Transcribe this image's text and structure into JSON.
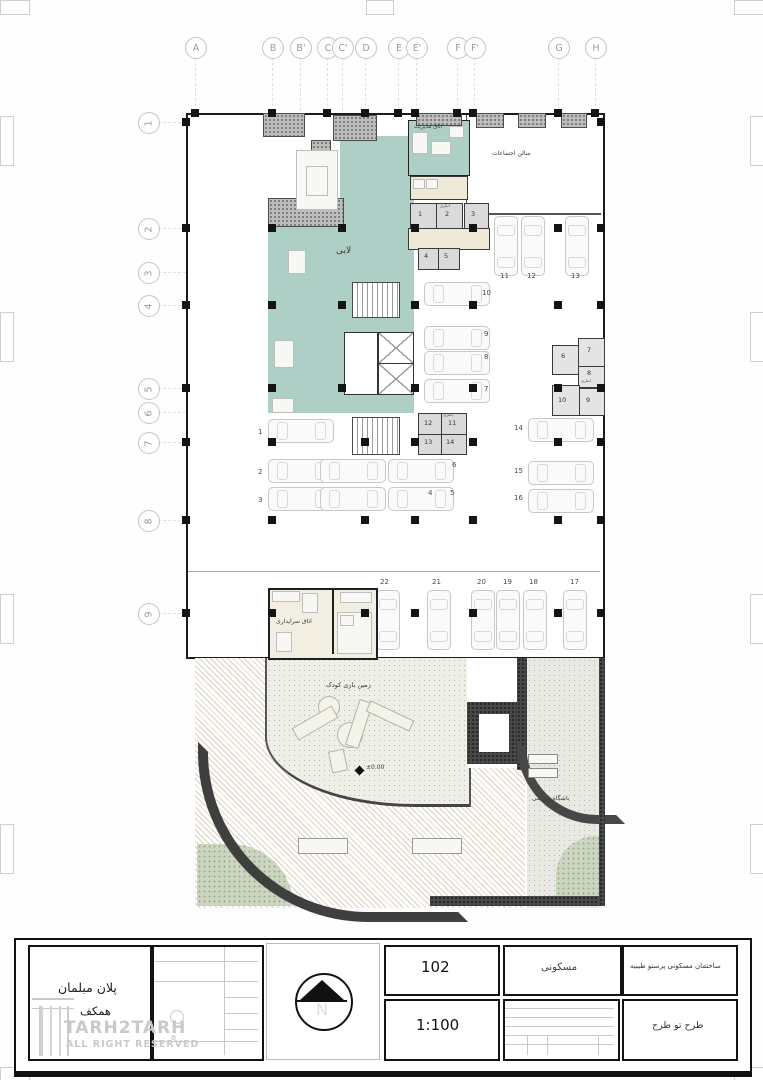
{
  "grid": {
    "cols": [
      "A",
      "B",
      "B'",
      "C",
      "C'",
      "D",
      "E",
      "E'",
      "F",
      "F'",
      "G",
      "H"
    ],
    "rows": [
      "1",
      "2",
      "3",
      "4",
      "5",
      "6",
      "7",
      "8",
      "9"
    ]
  },
  "rooms": {
    "lobby": "لابی",
    "management": "اتاق مدیریت",
    "assembly_hall": "سالن اجتماعات",
    "janitor": "اتاق سرایداری",
    "playground": "زمین بازی کودک",
    "gym": "باشگاه ورزشی",
    "storage": "انباری",
    "level_marker": "±0.00"
  },
  "parking": {
    "stalls": [
      "1",
      "2",
      "3",
      "4",
      "5",
      "6",
      "7",
      "8",
      "9",
      "10",
      "11",
      "12",
      "13",
      "14",
      "15",
      "16",
      "17",
      "18",
      "19",
      "20",
      "21",
      "22"
    ]
  },
  "storage": {
    "a": [
      "1",
      "2",
      "3",
      "4",
      "5"
    ],
    "b": [
      "6",
      "7",
      "8",
      "9",
      "10"
    ],
    "c": [
      "11",
      "12",
      "13",
      "14"
    ]
  },
  "titleblock": {
    "drawing_title": {
      "label_en": "DRAWING TITLE:",
      "label_fa": "عنوان نقشه",
      "title_fa": "پلان مبلمان",
      "subtitle_fa": "همکف"
    },
    "watermark": {
      "line1": "TARH2TARH",
      "line2": "ALL RIGHT RESERVED",
      "reg": "®"
    },
    "signature": {
      "file_no": "FILE NO.",
      "date": "DATE",
      "signature": "SIGNATURE",
      "designed_by": "DESIGNED BY:",
      "drawn_by": "DRAWN BY:",
      "checked_by": "CHECKED BY:",
      "approved_by": "APPROVED BY:",
      "field": "FIELD",
      "architecture": "ARCHITECTURE",
      "scale": "SCALE",
      "rev": "REV."
    },
    "north": {
      "letter": "N"
    },
    "sheet_number": {
      "label_en": "SHEET NUMBER",
      "label_fa": "شماره نقشه",
      "value": "102"
    },
    "scale": {
      "label_en": "COPY",
      "label_fa": "مقیاس",
      "value": "1:100"
    },
    "usage": {
      "label_fa": "کاربری",
      "value": "مسکونی"
    },
    "revision": {
      "sign": "SIGN.",
      "date": "DATE",
      "checked": "CHECKED",
      "description": "DESCRIPTION",
      "rev": "REV."
    },
    "project": {
      "label_en": "PROJECT TITLE:",
      "label_fa": "عنوان پروژه",
      "value_fa": "ساختمان مسکونی پرستو طیبیه"
    },
    "ordered": {
      "label_en": "ORDERED BY:",
      "label_fa": "کارفرما",
      "value_fa": "طرح تو طرح"
    }
  },
  "colors": {
    "lobby_teal": "#aecfc5",
    "stripe_tan": "#dcd1be",
    "wall_dark": "#3f3f3f"
  }
}
